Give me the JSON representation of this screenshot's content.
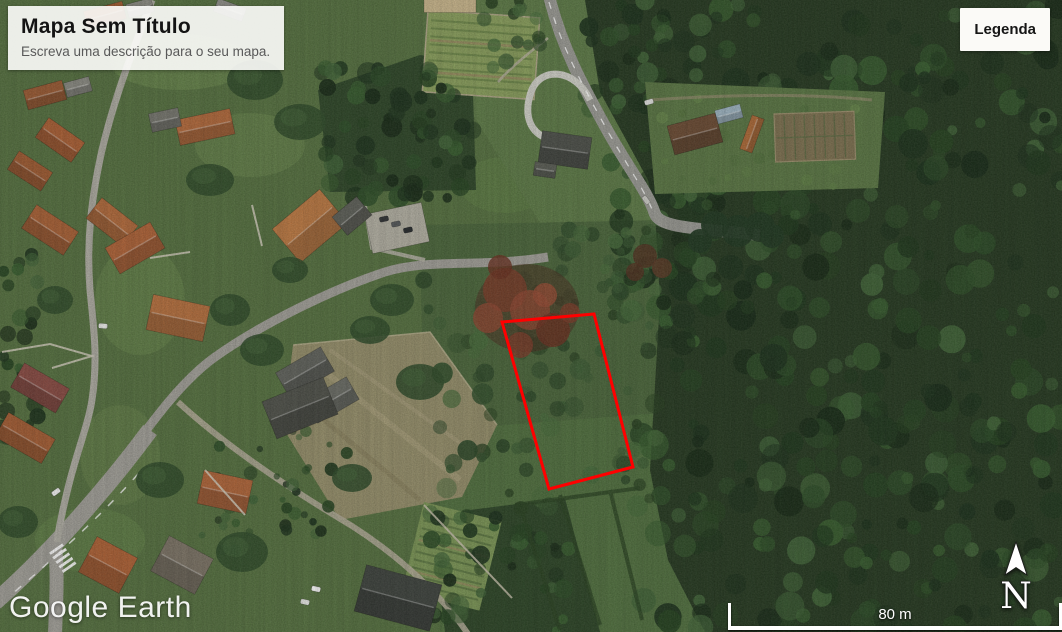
{
  "title_card": {
    "title": "Mapa Sem Título",
    "subtitle": "Escreva uma descrição para o seu mapa."
  },
  "legend": {
    "button_label": "Legenda"
  },
  "watermark": {
    "brand": "Google Earth"
  },
  "scale_bar": {
    "distance_label": "80 m"
  },
  "compass": {
    "direction_label": "N"
  },
  "parcel": {
    "outline_color": "#ff0000",
    "points": "502,322 594,314 633,467 549,489"
  }
}
